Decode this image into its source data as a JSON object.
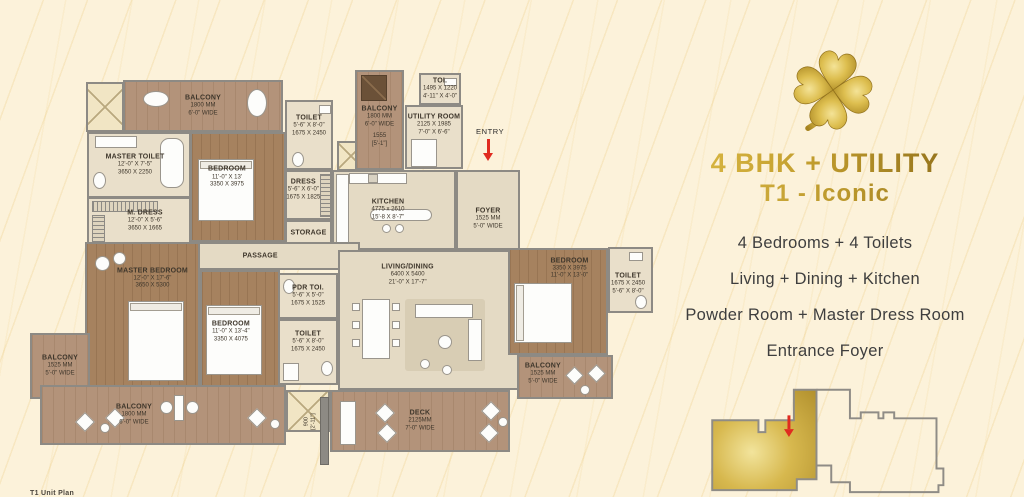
{
  "panel": {
    "title": "4 BHK + UTILITY",
    "subtitle": "T1 - Iconic",
    "features": [
      "4 Bedrooms + 4 Toilets",
      "Living + Dining + Kitchen",
      "Powder Room + Master Dress Room",
      "Entrance Foyer"
    ],
    "title_color": "#B8923B",
    "text_color": "#3E3E3E"
  },
  "plan": {
    "entry": "ENTRY",
    "dim_vertical": {
      "mm": "900",
      "ft": "[2'-11\"]"
    },
    "footer_fragment": "T1 Unit Plan",
    "rooms": {
      "balcony_top": {
        "name": "BALCONY",
        "d1": "1800 MM",
        "d2": "6'-0\" WIDE"
      },
      "master_toilet": {
        "name": "MASTER TOILET",
        "d1": "12'-0\" X 7'-5\"",
        "d2": "3650 X 2250"
      },
      "m_dress": {
        "name": "M. DRESS",
        "d1": "12'-0\" X 5'-6\"",
        "d2": "3650 X 1665"
      },
      "bedroom_top": {
        "name": "BEDROOM",
        "d1": "11'-0\" X 13'",
        "d2": "3350 X 3975"
      },
      "toilet_top": {
        "name": "TOILET",
        "d1": "5'-6\" X 8'-0\"",
        "d2": "1675 X 2450"
      },
      "dress": {
        "name": "DRESS",
        "d1": "5'-6\" X 6'-0\"",
        "d2": "1675 X 1825"
      },
      "storage": {
        "name": "STORAGE"
      },
      "balcony_top2": {
        "name": "BALCONY",
        "d1": "1800 MM",
        "d2": "6'-0\" WIDE",
        "e1": "1555",
        "e2": "[5'-1\"]"
      },
      "toi": {
        "name": "TOI.",
        "d1": "1495 X 1220",
        "d2": "4'-11\" X 4'-0\""
      },
      "utility": {
        "name": "UTILITY ROOM",
        "d1": "2125 X 1985",
        "d2": "7'-0\" X 6'-6\""
      },
      "kitchen": {
        "name": "KITCHEN",
        "d1": "4775 x 2610",
        "d2": "15'-8 X 8'-7\""
      },
      "foyer": {
        "name": "FOYER",
        "d1": "1525 MM",
        "d2": "5'-0\" WIDE"
      },
      "passage": {
        "name": "PASSAGE"
      },
      "master_bedroom": {
        "name": "MASTER BEDROOM",
        "d1": "12'-0\" X 17'-6\"",
        "d2": "3650 X 5300"
      },
      "bedroom_bl": {
        "name": "BEDROOM",
        "d1": "11'-0\" X 13'-4\"",
        "d2": "3350 X 4075"
      },
      "pdr_toi": {
        "name": "PDR TOI.",
        "d1": "5'-6\" X 5'-0\"",
        "d2": "1675 X 1525"
      },
      "toilet_bl": {
        "name": "TOILET",
        "d1": "5'-6\" X 8'-0\"",
        "d2": "1675 X 2450"
      },
      "living": {
        "name": "LIVING/DINING",
        "d1": "6400 X 5400",
        "d2": "21'-0\" X 17'-7\""
      },
      "bedroom_r": {
        "name": "BEDROOM",
        "d1": "3350 X 3975",
        "d2": "11'-0\" X 13'-0\""
      },
      "toilet_r": {
        "name": "TOILET",
        "d1": "1675 X 2450",
        "d2": "5'-6\" X 8'-0\""
      },
      "balcony_r": {
        "name": "BALCONY",
        "d1": "1525 MM",
        "d2": "5'-0\" WIDE"
      },
      "balcony_l": {
        "name": "BALCONY",
        "d1": "1525 MM",
        "d2": "5'-0\" WIDE"
      },
      "balcony_bottom": {
        "name": "BALCONY",
        "d1": "1800 MM",
        "d2": "6'-0\" WIDE"
      },
      "deck": {
        "name": "DECK",
        "d1": "2125MM",
        "d2": "7'-0\" WIDE"
      }
    }
  },
  "keyplan": {
    "highlight": "#C9A845",
    "outline": "#8A8A8A",
    "arrow": "#E02B20"
  }
}
